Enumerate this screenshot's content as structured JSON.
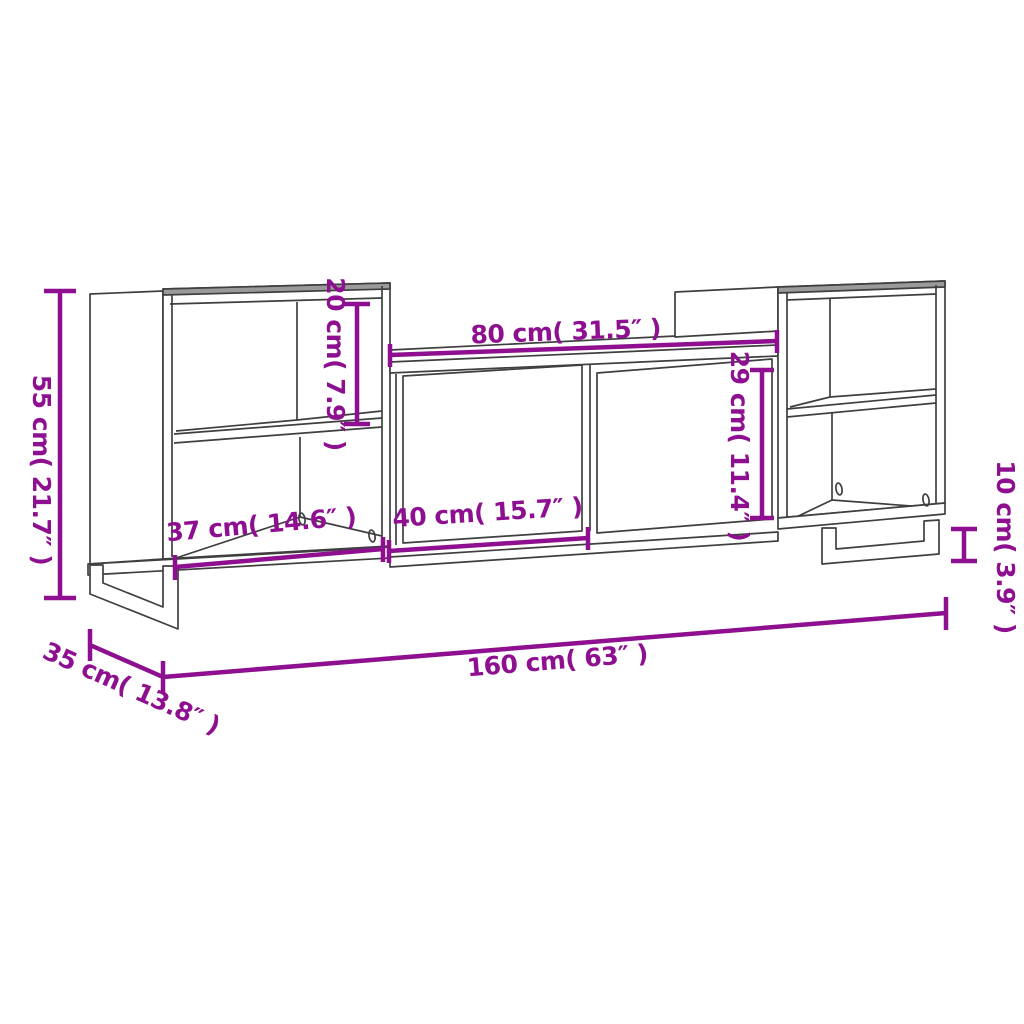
{
  "colors": {
    "dimension": "#8E0F90",
    "line": "#3F3F3F",
    "shading": "#9A9A9A"
  },
  "dimensions": {
    "overall_height": "55 cm( 21.7″ )",
    "upper_opening_height": "20 cm( 7.9″ )",
    "center_width": "80 cm( 31.5″ )",
    "door_height": "29 cm( 11.4″ )",
    "left_opening_width": "37 cm( 14.6″ )",
    "door_width": "40 cm( 15.7″ )",
    "leg_height": "10 cm( 3.9″ )",
    "overall_width": "160 cm( 63″ )",
    "depth": "35 cm( 13.8″ )"
  }
}
